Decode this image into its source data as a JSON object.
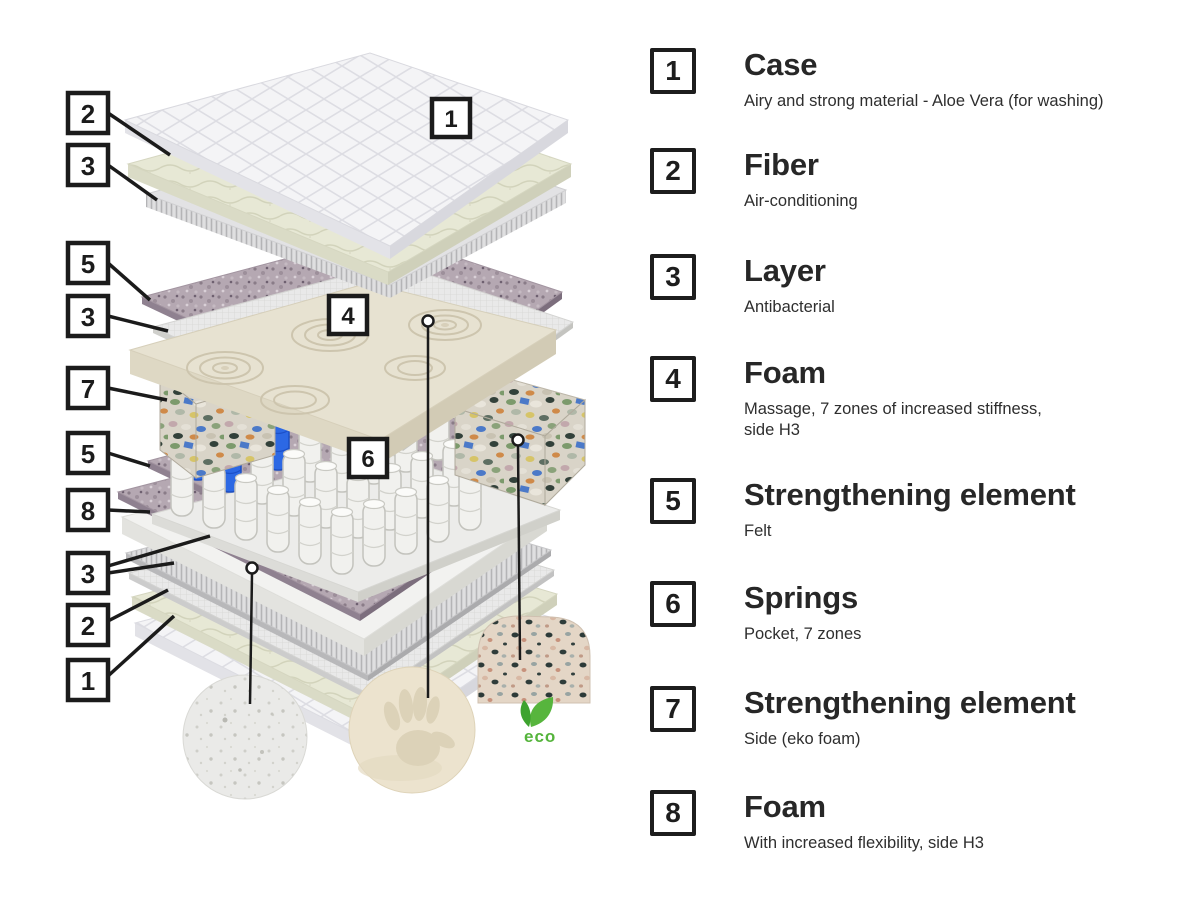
{
  "diagram": {
    "callouts": {
      "c2": "2",
      "c3": "3",
      "c5": "5",
      "c3b": "3",
      "c7": "7",
      "c5b": "5",
      "c8": "8",
      "c3c": "3",
      "c2b": "2",
      "c1b": "1",
      "i1": "1",
      "i4": "4",
      "i6": "6"
    },
    "eco_badge": "eco",
    "colors": {
      "outline_black": "#1b1b1b",
      "spring_blue": "#2c68e4",
      "eco_green": "#55b43c",
      "foam_cream": "#e7e2d1",
      "felt_purple": "#b5a8b2",
      "fiber_green": "#e7e8d5",
      "quilt_white": "#f4f4f6"
    }
  },
  "legend": {
    "items": [
      {
        "number": "1",
        "title": "Case",
        "description": "Airy and strong material - Aloe Vera (for washing)"
      },
      {
        "number": "2",
        "title": "Fiber",
        "description": "Air-conditioning"
      },
      {
        "number": "3",
        "title": "Layer",
        "description": "Antibacterial"
      },
      {
        "number": "4",
        "title": "Foam",
        "description": "Massage, 7 zones of increased stiffness,\nside H3"
      },
      {
        "number": "5",
        "title": "Strengthening element",
        "description": "Felt"
      },
      {
        "number": "6",
        "title": "Springs",
        "description": "Pocket, 7 zones"
      },
      {
        "number": "7",
        "title": "Strengthening element",
        "description": "Side (eko foam)"
      },
      {
        "number": "8",
        "title": "Foam",
        "description": "With increased flexibility, side H3"
      }
    ]
  }
}
